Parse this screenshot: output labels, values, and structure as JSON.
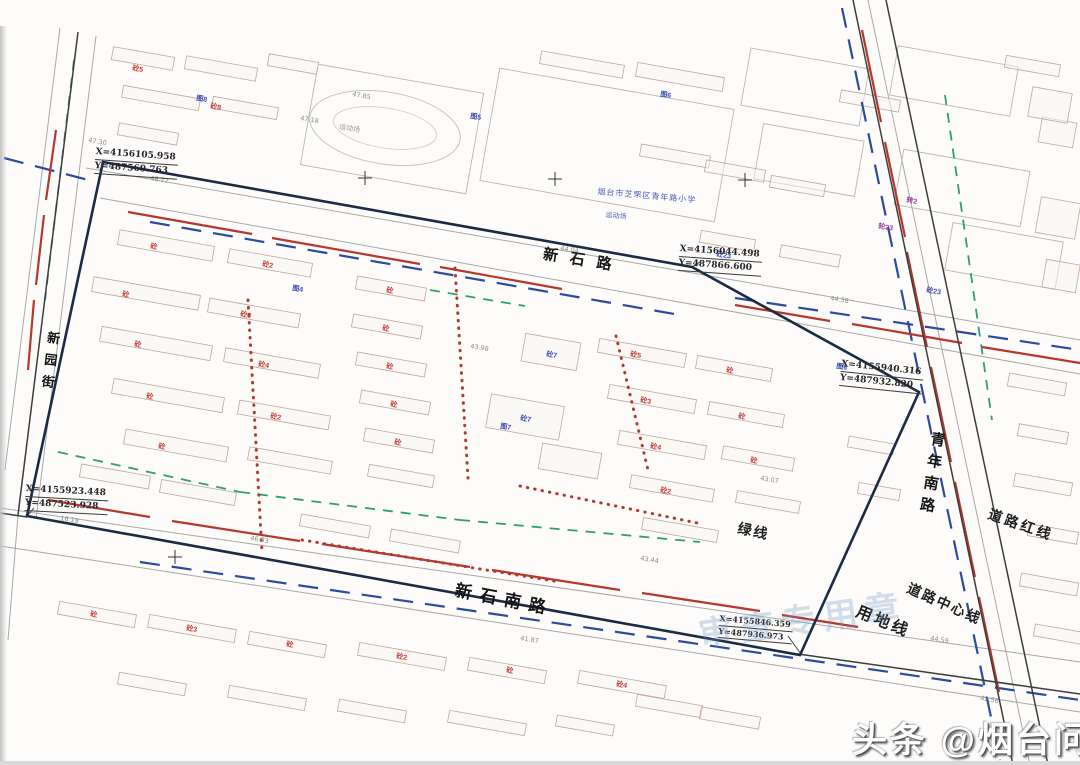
{
  "watermark": {
    "brand": "头条 @烟台问家"
  },
  "stamp": {
    "text": "审查专用章"
  },
  "roads": {
    "top": "新石路",
    "bottom": "新石南路",
    "right": "青年南路",
    "left": "新园街"
  },
  "annotations": {
    "road_red_line": "道路红线",
    "road_center_line": "道路中心线",
    "land_use_line": "用地线",
    "green_line": "绿线"
  },
  "pois": {
    "school": "烟台市芝罘区青年路小学",
    "sports_field": "运动场",
    "sports_field_2": "运动场"
  },
  "coordinates": [
    {
      "x": "X=4156105.958",
      "y": "Y=487569.763"
    },
    {
      "x": "X=4156044.498",
      "y": "Y=487866.600"
    },
    {
      "x": "X=4155940.316",
      "y": "Y=487932.820"
    },
    {
      "x": "X=4155923.448",
      "y": "Y=487523.928"
    },
    {
      "x": "X=4155846.359",
      "y": "Y=487936.973"
    }
  ],
  "colors": {
    "boundary": "#1b2b45",
    "red": "#b5382f",
    "blue_dash": "#2c4a9e",
    "green": "#2f9e78",
    "gray": "#a8a8a8",
    "dark": "#3d3d3d",
    "building": "#c0a8a0",
    "parcel": "#b8b8b8",
    "label_red": "#c23a35",
    "label_blue": "#3c4cb2",
    "label_purple": "#9340a2",
    "elev": "#8c8c8c",
    "leader": "#333333"
  },
  "map": {
    "boundary": "103,162 692,267 919,392 800,655 27,516",
    "dark_lines": [
      [
        78,
        32,
        18,
        515
      ],
      [
        853,
        0,
        1013,
        765
      ],
      [
        886,
        0,
        1048,
        765
      ],
      [
        0,
        513,
        27,
        517
      ],
      [
        798,
        654,
        1080,
        694
      ]
    ],
    "gray_lines": [
      [
        86,
        168,
        1080,
        340
      ],
      [
        100,
        198,
        1080,
        374
      ],
      [
        0,
        508,
        1080,
        662
      ],
      [
        0,
        546,
        1080,
        712
      ],
      [
        96,
        36,
        36,
        519
      ],
      [
        60,
        28,
        5,
        470
      ],
      [
        868,
        0,
        1030,
        765
      ],
      [
        18,
        515,
        8,
        640
      ]
    ],
    "red_solid": [
      [
        128,
        212,
        252,
        234
      ],
      [
        272,
        238,
        420,
        264
      ],
      [
        440,
        267,
        562,
        289
      ],
      [
        735,
        305,
        830,
        321
      ],
      [
        852,
        324,
        962,
        343
      ],
      [
        982,
        347,
        1080,
        363
      ],
      [
        48,
        500,
        150,
        517
      ],
      [
        172,
        521,
        300,
        541
      ],
      [
        322,
        544,
        470,
        567
      ],
      [
        492,
        570,
        620,
        590
      ],
      [
        642,
        593,
        760,
        611
      ],
      [
        782,
        615,
        858,
        627
      ],
      [
        862,
        30,
        881,
        122
      ],
      [
        885,
        142,
        905,
        237
      ],
      [
        907,
        252,
        927,
        347
      ],
      [
        931,
        367,
        951,
        462
      ],
      [
        955,
        482,
        975,
        577
      ],
      [
        979,
        597,
        999,
        692
      ],
      [
        56,
        130,
        46,
        200
      ],
      [
        44,
        215,
        36,
        285
      ],
      [
        34,
        300,
        28,
        370
      ]
    ],
    "red_dotted": [
      [
        455,
        268,
        468,
        478
      ],
      [
        248,
        300,
        262,
        552
      ],
      [
        520,
        486,
        702,
        524
      ],
      [
        616,
        336,
        648,
        470
      ],
      [
        302,
        540,
        560,
        582
      ]
    ],
    "blue_dash": [
      [
        4,
        158,
        96,
        182
      ],
      [
        150,
        222,
        680,
        315
      ],
      [
        735,
        298,
        1080,
        350
      ],
      [
        842,
        8,
        1000,
        760
      ],
      [
        140,
        562,
        1080,
        700
      ]
    ],
    "green_dash": [
      [
        58,
        452,
        240,
        492
      ],
      [
        240,
        492,
        460,
        520
      ],
      [
        460,
        520,
        700,
        542
      ],
      [
        945,
        95,
        992,
        420
      ],
      [
        430,
        290,
        525,
        306
      ],
      [
        74,
        60,
        45,
        300
      ]
    ],
    "leaders": [
      [
        100,
        170,
        103,
        163
      ],
      [
        700,
        262,
        692,
        267
      ],
      [
        898,
        380,
        918,
        391
      ],
      [
        34,
        508,
        28,
        515
      ],
      [
        788,
        636,
        801,
        654
      ]
    ],
    "crosses": [
      [
        365,
        178
      ],
      [
        555,
        179
      ],
      [
        745,
        180
      ],
      [
        175,
        557
      ]
    ],
    "track": {
      "cx": 385,
      "cy": 128,
      "rx": 76,
      "ry": 36,
      "rx2": 52,
      "ry2": 20,
      "rot": 9
    },
    "big_parcels": [
      [
        745,
        58,
        120,
        58,
        10
      ],
      [
        893,
        56,
        122,
        50,
        10
      ],
      [
        758,
        132,
        102,
        56,
        10
      ],
      [
        898,
        160,
        128,
        56,
        10
      ],
      [
        948,
        232,
        112,
        48,
        10
      ],
      [
        488,
        88,
        238,
        114,
        10
      ],
      [
        308,
        78,
        168,
        102,
        10
      ]
    ],
    "buildings": [
      [
        112,
        52,
        62,
        13,
        10
      ],
      [
        185,
        62,
        72,
        13,
        10
      ],
      [
        268,
        58,
        50,
        12,
        10
      ],
      [
        122,
        92,
        78,
        12,
        10
      ],
      [
        212,
        102,
        66,
        12,
        10
      ],
      [
        118,
        128,
        60,
        12,
        10
      ],
      [
        540,
        58,
        84,
        13,
        10
      ],
      [
        636,
        70,
        88,
        14,
        10
      ],
      [
        840,
        95,
        60,
        12,
        10
      ],
      [
        1005,
        60,
        55,
        12,
        10
      ],
      [
        1040,
        120,
        35,
        25,
        10
      ],
      [
        1030,
        90,
        40,
        30,
        10
      ],
      [
        700,
        235,
        55,
        12,
        10
      ],
      [
        780,
        250,
        60,
        12,
        10
      ],
      [
        640,
        150,
        70,
        12,
        10
      ],
      [
        705,
        165,
        60,
        12,
        10
      ],
      [
        770,
        180,
        55,
        12,
        10
      ],
      [
        118,
        238,
        96,
        15,
        10
      ],
      [
        228,
        256,
        84,
        14,
        10
      ],
      [
        92,
        286,
        108,
        15,
        10
      ],
      [
        208,
        306,
        92,
        14,
        10
      ],
      [
        100,
        336,
        112,
        15,
        10
      ],
      [
        224,
        356,
        96,
        14,
        10
      ],
      [
        112,
        388,
        112,
        15,
        10
      ],
      [
        238,
        408,
        92,
        14,
        10
      ],
      [
        124,
        438,
        104,
        15,
        10
      ],
      [
        248,
        454,
        84,
        13,
        10
      ],
      [
        356,
        282,
        70,
        13,
        10
      ],
      [
        352,
        320,
        70,
        13,
        10
      ],
      [
        356,
        358,
        70,
        13,
        10
      ],
      [
        360,
        396,
        70,
        13,
        10
      ],
      [
        364,
        434,
        70,
        13,
        10
      ],
      [
        368,
        470,
        66,
        12,
        10
      ],
      [
        523,
        338,
        56,
        28,
        10
      ],
      [
        488,
        400,
        74,
        34,
        10
      ],
      [
        540,
        448,
        60,
        26,
        10
      ],
      [
        598,
        346,
        88,
        14,
        10
      ],
      [
        696,
        362,
        76,
        13,
        10
      ],
      [
        608,
        392,
        88,
        14,
        10
      ],
      [
        708,
        408,
        76,
        13,
        10
      ],
      [
        618,
        438,
        88,
        14,
        10
      ],
      [
        722,
        452,
        72,
        13,
        10
      ],
      [
        630,
        482,
        84,
        13,
        10
      ],
      [
        736,
        496,
        64,
        12,
        10
      ],
      [
        642,
        524,
        76,
        12,
        10
      ],
      [
        80,
        470,
        70,
        13,
        10
      ],
      [
        160,
        486,
        76,
        13,
        10
      ],
      [
        300,
        520,
        70,
        12,
        10
      ],
      [
        390,
        535,
        70,
        12,
        10
      ],
      [
        58,
        608,
        78,
        13,
        10
      ],
      [
        148,
        622,
        88,
        13,
        10
      ],
      [
        248,
        638,
        78,
        13,
        10
      ],
      [
        358,
        650,
        88,
        13,
        10
      ],
      [
        468,
        664,
        78,
        13,
        10
      ],
      [
        578,
        678,
        88,
        13,
        10
      ],
      [
        118,
        678,
        68,
        12,
        10
      ],
      [
        228,
        692,
        78,
        12,
        10
      ],
      [
        338,
        705,
        68,
        12,
        10
      ],
      [
        448,
        717,
        78,
        12,
        10
      ],
      [
        556,
        720,
        58,
        11,
        10
      ],
      [
        636,
        700,
        66,
        12,
        10
      ],
      [
        700,
        712,
        60,
        12,
        10
      ],
      [
        1008,
        378,
        58,
        13,
        10
      ],
      [
        1018,
        428,
        50,
        12,
        10
      ],
      [
        1014,
        478,
        58,
        13,
        10
      ],
      [
        1028,
        528,
        50,
        12,
        10
      ],
      [
        1020,
        578,
        58,
        13,
        10
      ],
      [
        1034,
        628,
        48,
        12,
        10
      ],
      [
        1038,
        200,
        40,
        36,
        10
      ],
      [
        1044,
        262,
        34,
        28,
        10
      ],
      [
        848,
        440,
        46,
        11,
        10
      ],
      [
        858,
        486,
        42,
        11,
        10
      ]
    ],
    "parcel_labels": [
      {
        "t": "砼",
        "x": 150,
        "y": 248,
        "c": "red"
      },
      {
        "t": "砼2",
        "x": 262,
        "y": 266,
        "c": "red"
      },
      {
        "t": "砼",
        "x": 122,
        "y": 296,
        "c": "red"
      },
      {
        "t": "砼3",
        "x": 240,
        "y": 316,
        "c": "red"
      },
      {
        "t": "砼",
        "x": 134,
        "y": 346,
        "c": "red"
      },
      {
        "t": "砼4",
        "x": 258,
        "y": 366,
        "c": "red"
      },
      {
        "t": "砼",
        "x": 146,
        "y": 398,
        "c": "red"
      },
      {
        "t": "砼2",
        "x": 270,
        "y": 418,
        "c": "red"
      },
      {
        "t": "砼",
        "x": 158,
        "y": 448,
        "c": "red"
      },
      {
        "t": "砼",
        "x": 386,
        "y": 292,
        "c": "red"
      },
      {
        "t": "砼",
        "x": 382,
        "y": 330,
        "c": "red"
      },
      {
        "t": "砼",
        "x": 386,
        "y": 368,
        "c": "red"
      },
      {
        "t": "砼",
        "x": 390,
        "y": 406,
        "c": "red"
      },
      {
        "t": "砼",
        "x": 394,
        "y": 444,
        "c": "red"
      },
      {
        "t": "砼5",
        "x": 630,
        "y": 356,
        "c": "red"
      },
      {
        "t": "砼",
        "x": 726,
        "y": 372,
        "c": "red"
      },
      {
        "t": "砼3",
        "x": 640,
        "y": 402,
        "c": "red"
      },
      {
        "t": "砼",
        "x": 738,
        "y": 418,
        "c": "red"
      },
      {
        "t": "砼4",
        "x": 650,
        "y": 448,
        "c": "red"
      },
      {
        "t": "砼",
        "x": 750,
        "y": 462,
        "c": "red"
      },
      {
        "t": "砼2",
        "x": 660,
        "y": 492,
        "c": "red"
      },
      {
        "t": "砼",
        "x": 90,
        "y": 616,
        "c": "red"
      },
      {
        "t": "砼3",
        "x": 186,
        "y": 630,
        "c": "red"
      },
      {
        "t": "砼",
        "x": 286,
        "y": 646,
        "c": "red"
      },
      {
        "t": "砼2",
        "x": 396,
        "y": 658,
        "c": "red"
      },
      {
        "t": "砼",
        "x": 506,
        "y": 672,
        "c": "red"
      },
      {
        "t": "砼4",
        "x": 616,
        "y": 686,
        "c": "red"
      },
      {
        "t": "砼8",
        "x": 210,
        "y": 108,
        "c": "red"
      },
      {
        "t": "砼5",
        "x": 132,
        "y": 70,
        "c": "red"
      },
      {
        "t": "砼7",
        "x": 546,
        "y": 356,
        "c": "blue"
      },
      {
        "t": "砼7",
        "x": 520,
        "y": 420,
        "c": "blue"
      },
      {
        "t": "砼23",
        "x": 716,
        "y": 256,
        "c": "blue"
      },
      {
        "t": "砼23",
        "x": 926,
        "y": 292,
        "c": "blue"
      },
      {
        "t": "转2",
        "x": 906,
        "y": 202,
        "c": "purple"
      },
      {
        "t": "轮23",
        "x": 878,
        "y": 228,
        "c": "purple"
      },
      {
        "t": "图4",
        "x": 292,
        "y": 290,
        "c": "blue"
      },
      {
        "t": "图5",
        "x": 470,
        "y": 118,
        "c": "blue"
      },
      {
        "t": "图6",
        "x": 660,
        "y": 96,
        "c": "blue"
      },
      {
        "t": "图8",
        "x": 196,
        "y": 100,
        "c": "blue"
      },
      {
        "t": "图7",
        "x": 500,
        "y": 428,
        "c": "blue"
      },
      {
        "t": "图6",
        "x": 836,
        "y": 368,
        "c": "blue"
      }
    ],
    "elevations": [
      {
        "t": "47.85",
        "x": 352,
        "y": 96
      },
      {
        "t": "47.30",
        "x": 88,
        "y": 142
      },
      {
        "t": "43.98",
        "x": 470,
        "y": 348
      },
      {
        "t": "44.04",
        "x": 560,
        "y": 250
      },
      {
        "t": "43.44",
        "x": 640,
        "y": 560
      },
      {
        "t": "41.87",
        "x": 520,
        "y": 640
      },
      {
        "t": "46.93",
        "x": 250,
        "y": 540
      },
      {
        "t": "48.77",
        "x": 150,
        "y": 180
      },
      {
        "t": "44.59",
        "x": 930,
        "y": 640
      },
      {
        "t": "16.19",
        "x": 60,
        "y": 520
      },
      {
        "t": "43.07",
        "x": 760,
        "y": 480
      },
      {
        "t": "44.38",
        "x": 830,
        "y": 300
      },
      {
        "t": "47.18",
        "x": 300,
        "y": 120
      },
      {
        "t": "42.56",
        "x": 980,
        "y": 700
      }
    ]
  }
}
